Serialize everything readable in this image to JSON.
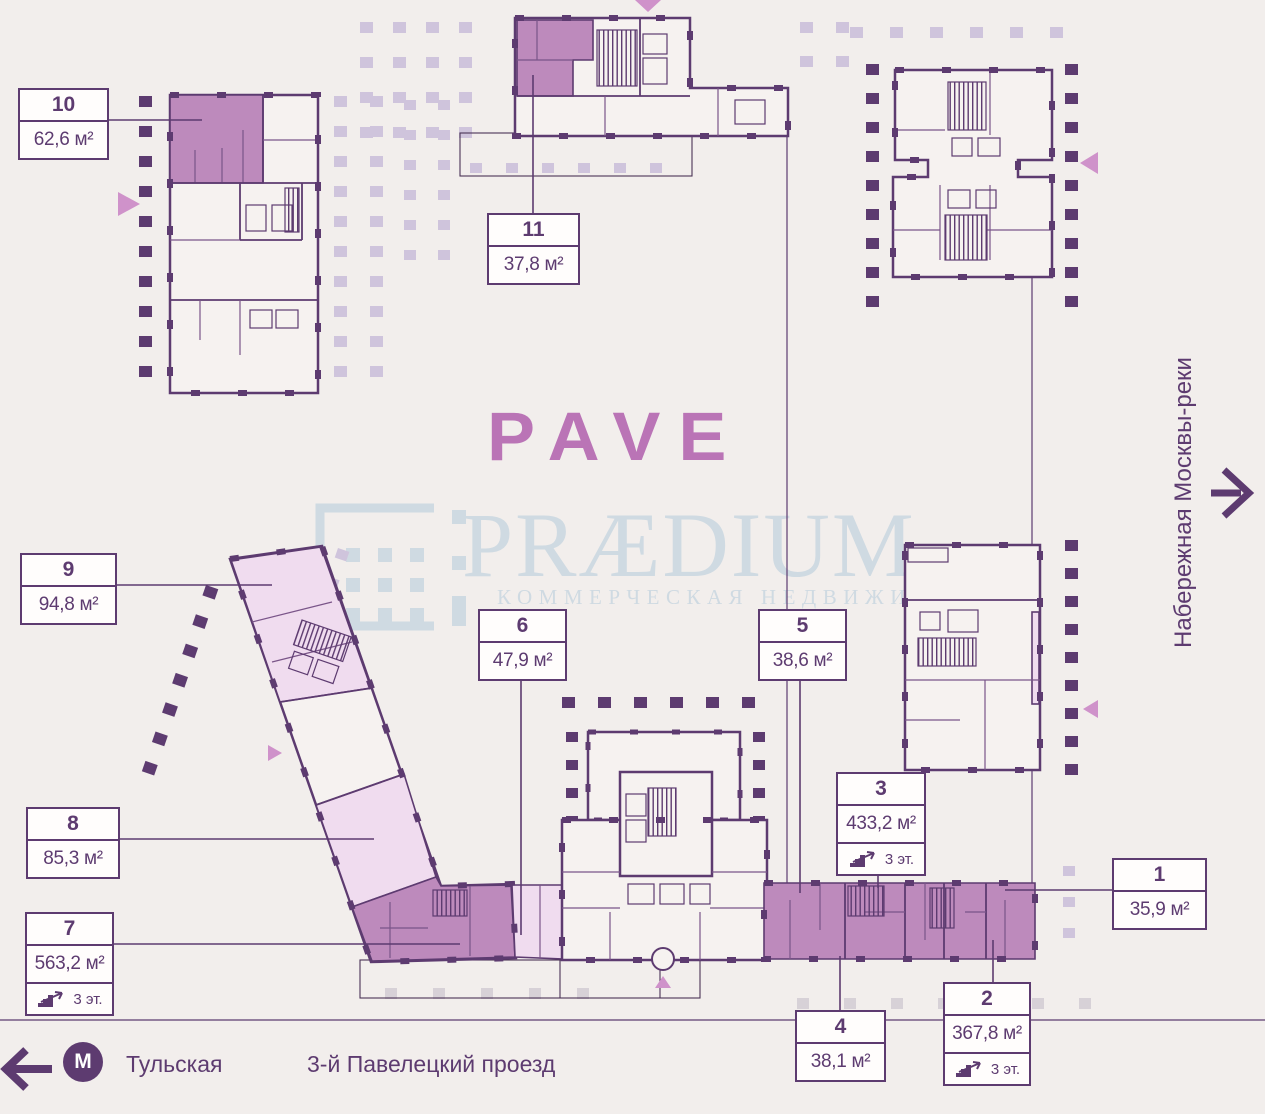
{
  "page": {
    "background": "#f2eeec",
    "title": "PAVE"
  },
  "colors": {
    "walls": "#5d3b70",
    "unit_highlight_dark": "#bd8abc",
    "unit_highlight_light": "#f0dcef",
    "accent_triangle": "#cf92ca",
    "logo_pink": "#ba74b6",
    "watermark_blue": "#cfdae2",
    "dot_dark": "#5d3b70",
    "dot_light": "#cfc4dc"
  },
  "logo": {
    "text": "PAVE"
  },
  "watermark": {
    "brand": "PRÆDIUM",
    "tagline": "КОММЕРЧЕСКАЯ НЕДВИЖИМОСТЬ"
  },
  "map": {
    "embankment": "Набережная Москвы-реки",
    "street": "3-й Павелецкий проезд",
    "metro_station": "Тульская",
    "metro_symbol": "М"
  },
  "units": [
    {
      "id": "10",
      "area": "62,6 м²",
      "highlight": "dark"
    },
    {
      "id": "11",
      "area": "37,8 м²",
      "highlight": "dark"
    },
    {
      "id": "9",
      "area": "94,8 м²",
      "highlight": "light"
    },
    {
      "id": "6",
      "area": "47,9 м²",
      "highlight": "light"
    },
    {
      "id": "5",
      "area": "38,6 м²",
      "highlight": "dark"
    },
    {
      "id": "3",
      "area": "433,2 м²",
      "floors": "3 эт.",
      "highlight": "dark"
    },
    {
      "id": "8",
      "area": "85,3 м²",
      "highlight": "light"
    },
    {
      "id": "7",
      "area": "563,2 м²",
      "floors": "3 эт.",
      "highlight": "dark"
    },
    {
      "id": "1",
      "area": "35,9 м²",
      "highlight": "dark"
    },
    {
      "id": "4",
      "area": "38,1 м²",
      "highlight": "dark"
    },
    {
      "id": "2",
      "area": "367,8 м²",
      "floors": "3 эт.",
      "highlight": "dark"
    }
  ]
}
